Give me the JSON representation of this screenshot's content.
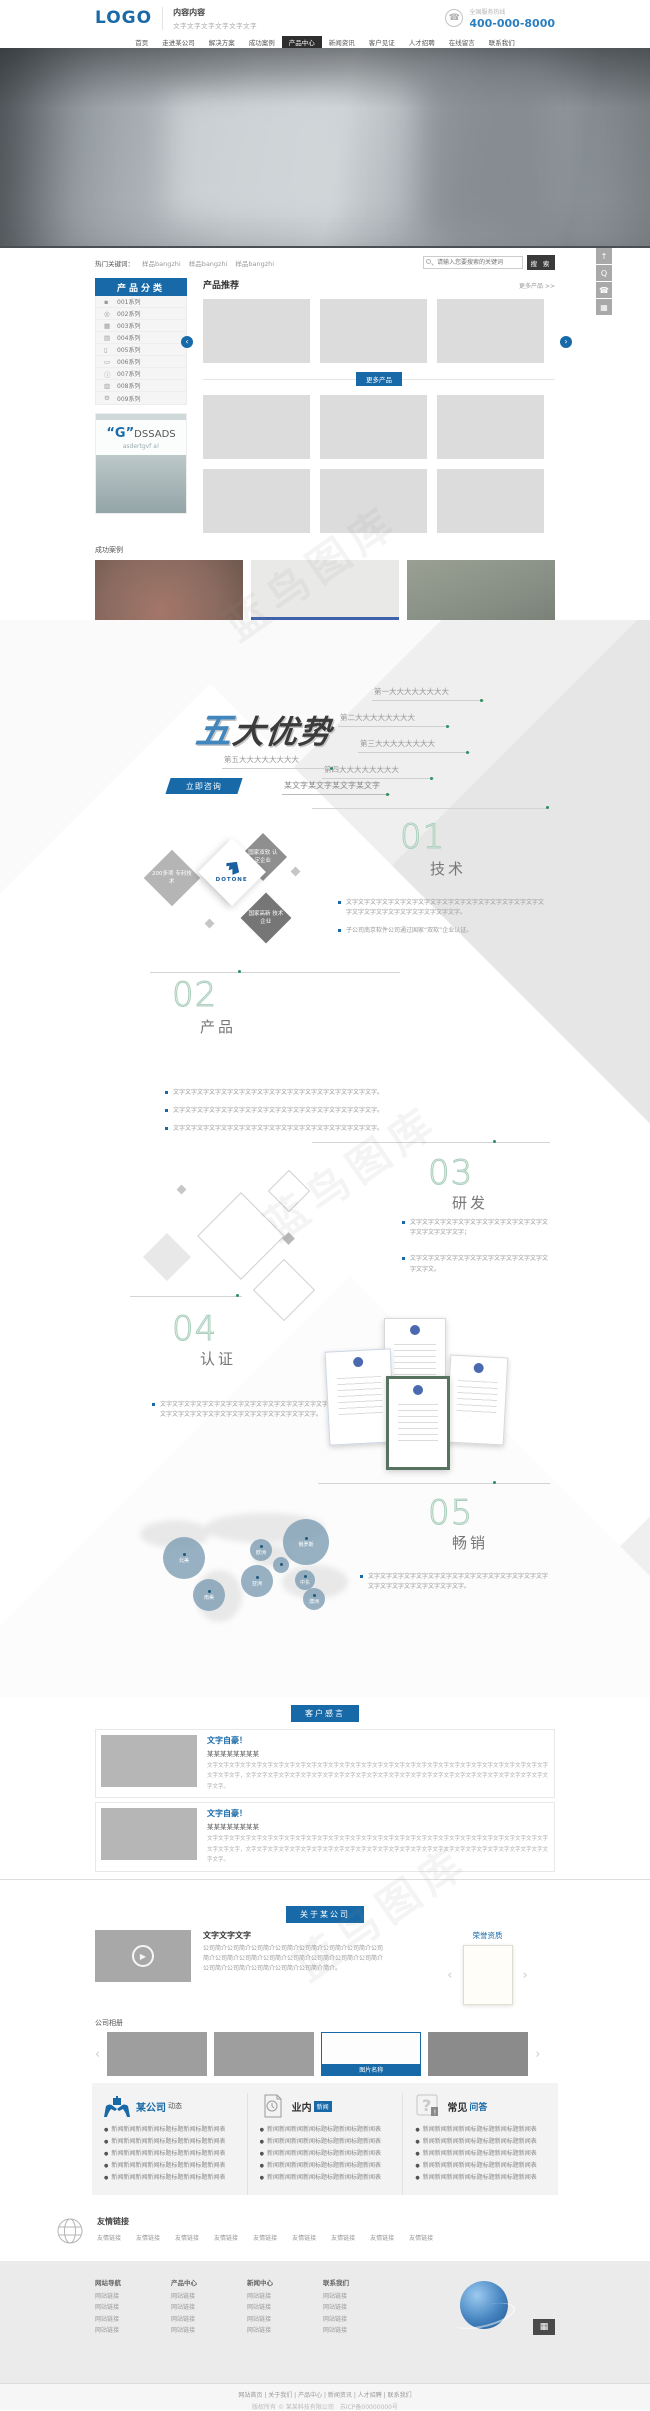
{
  "header": {
    "logo": "LOGO",
    "slogan_title": "内容内容",
    "slogan_sub": "文字文字文字文字文字文字",
    "hotline_label": "全国服务热线",
    "hotline": "400-000-8000",
    "phone_icon": "phone-icon"
  },
  "nav": {
    "items": [
      {
        "label": "首页"
      },
      {
        "label": "走进某公司"
      },
      {
        "label": "解决方案"
      },
      {
        "label": "成功案例"
      },
      {
        "label": "产品中心",
        "active": true
      },
      {
        "label": "新闻资讯"
      },
      {
        "label": "客户见证"
      },
      {
        "label": "人才招聘"
      },
      {
        "label": "在线留言"
      },
      {
        "label": "联系我们"
      }
    ]
  },
  "search": {
    "hot_label": "热门关键词：",
    "keywords": [
      "样品bangzhi",
      "样品bangzhi",
      "样品bangzhi"
    ],
    "placeholder": "请输入您要搜索的关键词",
    "button": "搜 索"
  },
  "sidebar": {
    "title": "产品分类",
    "items": [
      {
        "icon": "▪",
        "label": "001系列"
      },
      {
        "icon": "◎",
        "label": "002系列"
      },
      {
        "icon": "▦",
        "label": "003系列"
      },
      {
        "icon": "▤",
        "label": "004系列"
      },
      {
        "icon": "▯",
        "label": "005系列"
      },
      {
        "icon": "▭",
        "label": "006系列"
      },
      {
        "icon": "ⓘ",
        "label": "007系列"
      },
      {
        "icon": "▥",
        "label": "008系列"
      },
      {
        "icon": "⚙",
        "label": "009系列"
      }
    ],
    "ad": {
      "quote_g": "“G”",
      "brand": "DSSADS",
      "sub": "asdertgvf a!"
    }
  },
  "products": {
    "title": "产品推荐",
    "more_link": "更多产品 >>",
    "more_button": "更多产品"
  },
  "cases": {
    "title": "成功案例",
    "caption": "案例名称"
  },
  "advantages": {
    "logo_first": "五",
    "logo_rest": "大优势",
    "items": [
      "第一大大大大大大大大",
      "第二大大大大大大大大",
      "第三大大大大大大大大",
      "第四大大大大大大大大",
      "第五大大大大大大大大"
    ],
    "consult": "立即咨询",
    "note": "某文字某文字某文字某文字"
  },
  "sections": {
    "s1": {
      "num": "01",
      "title": "技术",
      "diamonds": {
        "left": "200多项 专利技术",
        "top": "国家双软 认定企业",
        "bottom": "国家高新 技术企业",
        "brand": "DOTONE"
      },
      "bullets": [
        "文字文字文字文字文字文字文字文字文字文字文字文字文字文字文字文字文字文字文字文字文字文字文字文字文字文字。",
        "子公司南京软件公司通过国家“双软”企业认证。"
      ]
    },
    "s2": {
      "num": "02",
      "title": "产品",
      "bullets": [
        "文字文字文字文字文字文字文字文字文字文字文字文字文字文字文字文字文字。",
        "文字文字文字文字文字文字文字文字文字文字文字文字文字文字文字文字文字。",
        "文字文字文字文字文字文字文字文字文字文字文字文字文字文字文字文字文字。"
      ]
    },
    "s3": {
      "num": "03",
      "title": "研发",
      "bullets": [
        "文字文字文字文字文字文字文字文字文字文字文字文字文字文字文字文字；",
        "文字文字文字文字文字文字文字文字文字文字文字文字文字文。"
      ]
    },
    "s4": {
      "num": "04",
      "title": "认证",
      "bullets": [
        "文字文字文字文字文字文字文字文字文字文字文字文字文字文字文字文字文字文字文字文字文字文字文字文字文字文字文字。"
      ]
    },
    "s5": {
      "num": "05",
      "title": "畅销",
      "bullets": [
        "文字文字文字文字文字文字文字文字文字文字文字文字文字文字文字文字文字文字文字文字文字文字文字。"
      ],
      "bubbles": [
        {
          "label": "北美",
          "x": 163,
          "y": 917,
          "r": 21
        },
        {
          "label": "欧洲",
          "x": 250,
          "y": 919,
          "r": 11
        },
        {
          "label": "俄罗斯",
          "x": 283,
          "y": 899,
          "r": 23
        },
        {
          "label": "亚洲",
          "x": 241,
          "y": 945,
          "r": 16
        },
        {
          "label": "中东",
          "x": 295,
          "y": 950,
          "r": 10
        },
        {
          "label": "南美",
          "x": 193,
          "y": 959,
          "r": 16
        },
        {
          "label": "澳洲",
          "x": 303,
          "y": 968,
          "r": 11
        },
        {
          "label": "",
          "x": 273,
          "y": 937,
          "r": 8
        }
      ]
    }
  },
  "testimonials": {
    "tab": "客户感言",
    "items": [
      {
        "title": "文字自豪！",
        "subtitle": "某某某某某某某某",
        "body": "文字文字文字文字文字文字文字文字文字文字文字文字文字文字文字文字文字文字文字文字文字文字文字文字文字文字文字文字文字文字文字文字文字文字，文字文字文字文字文字文字文字文字文字文字文字文字文字文字文字文字文字文字文字文字文字文字文字文字文字文字文字文字文字。"
      },
      {
        "title": "文字自豪！",
        "subtitle": "某某某某某某某某",
        "body": "文字文字文字文字文字文字文字文字文字文字文字文字文字文字文字文字文字文字文字文字文字文字文字文字文字文字文字文字文字文字文字文字文字文字，文字文字文字文字文字文字文字文字文字文字文字文字文字文字文字文字文字文字文字文字文字文字文字文字文字文字文字文字文字。"
      }
    ]
  },
  "about": {
    "tab": "关于某公司",
    "heading": "文字文字文字",
    "body": "公司简介公司简介公司简介公司简介公司简介公司简介公司简介公司简介公司简介公司简介公司简介公司简介公司简介公司简介公司简介公司简介公司简介公司简介公司简介公司简介简介。",
    "honor_label": "荣誉资质"
  },
  "album": {
    "title": "公司相册",
    "caption": "图片名称"
  },
  "news": {
    "columns": [
      {
        "title_a": "某公司",
        "title_b": "动态",
        "icon": "hands-gift-icon",
        "items": [
          "新闻新闻新闻新闻标题标题新闻标题新闻表",
          "新闻新闻新闻新闻标题标题新闻标题新闻表",
          "新闻新闻新闻新闻标题标题新闻标题新闻表",
          "新闻新闻新闻新闻标题标题新闻标题新闻表",
          "新闻新闻新闻新闻标题标题新闻标题新闻表"
        ]
      },
      {
        "title_a": "业内",
        "title_b": "新闻",
        "icon": "document-clock-icon",
        "items": [
          "新闻新闻新闻新闻标题标题新闻标题新闻表",
          "新闻新闻新闻新闻标题标题新闻标题新闻表",
          "新闻新闻新闻新闻标题标题新闻标题新闻表",
          "新闻新闻新闻新闻标题标题新闻标题新闻表",
          "新闻新闻新闻新闻标题标题新闻标题新闻表"
        ]
      },
      {
        "title_a": "常见",
        "title_b": "问答",
        "icon": "question-icon",
        "items": [
          "新闻新闻新闻新闻标题标题新闻标题新闻表",
          "新闻新闻新闻新闻标题标题新闻标题新闻表",
          "新闻新闻新闻新闻标题标题新闻标题新闻表",
          "新闻新闻新闻新闻标题标题新闻标题新闻表",
          "新闻新闻新闻新闻标题标题新闻标题新闻表"
        ]
      }
    ]
  },
  "links": {
    "title": "友情链接",
    "items": [
      "友情链接",
      "友情链接",
      "友情链接",
      "友情链接",
      "友情链接",
      "友情链接",
      "友情链接",
      "友情链接",
      "友情链接"
    ]
  },
  "footer": {
    "columns": [
      {
        "heading": "网站导航",
        "links": [
          "网站链接",
          "网站链接",
          "网站链接",
          "网站链接"
        ]
      },
      {
        "heading": "产品中心",
        "links": [
          "网站链接",
          "网站链接",
          "网站链接",
          "网站链接"
        ]
      },
      {
        "heading": "新闻中心",
        "links": [
          "网站链接",
          "网站链接",
          "网站链接",
          "网站链接"
        ]
      },
      {
        "heading": "联系我们",
        "links": [
          "网站链接",
          "网站链接",
          "网站链接",
          "网站链接"
        ]
      }
    ],
    "bottom_links": "网站首页 | 关于我们 | 产品中心 | 新闻资讯 | 人才招聘 | 联系我们",
    "copyright": "版权所有 © 某某科技有限公司　苏ICP备00000000号"
  },
  "toolbar": {
    "back_to_top": "↑",
    "qq": "Q",
    "phone": "☎",
    "qrcode": "▦"
  },
  "watermark": "蓝鸟图库",
  "colors": {
    "primary_blue": "#1769a8",
    "link_blue": "#2a7fc1",
    "accent_green": "#2f8f5f",
    "nav_dark": "#2e2e2e",
    "caption_blue": "#3f62ad"
  }
}
